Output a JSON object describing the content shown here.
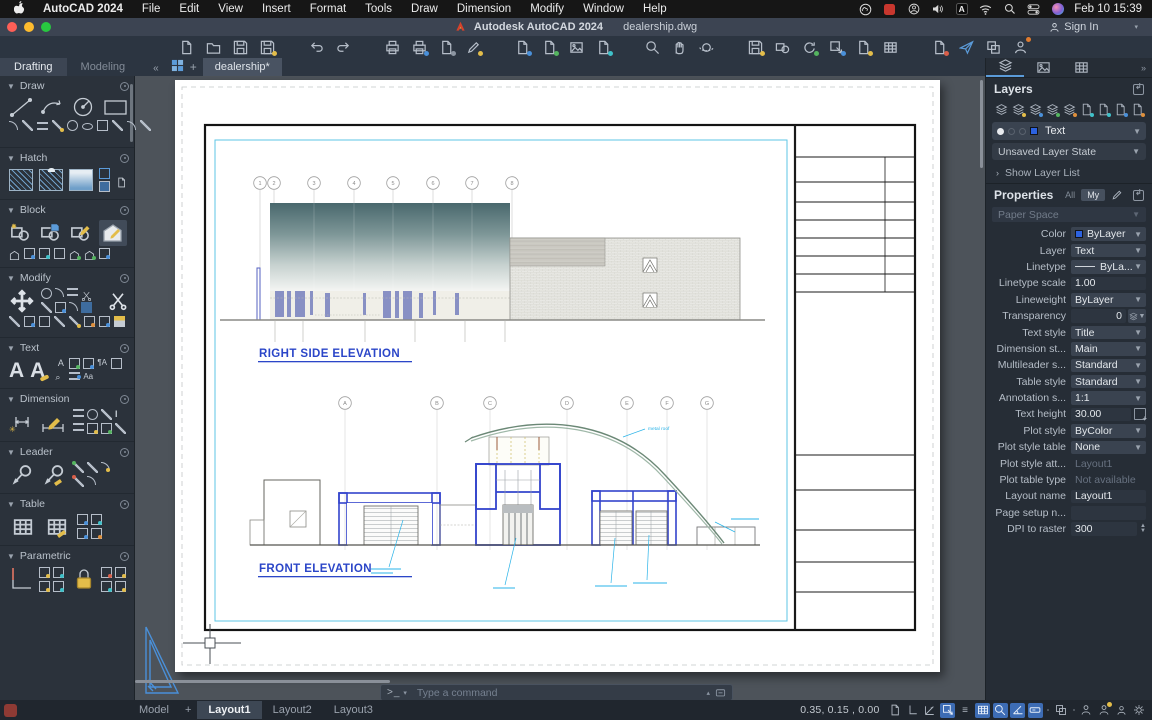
{
  "menubar": {
    "app_name": "AutoCAD 2024",
    "items": [
      "File",
      "Edit",
      "View",
      "Insert",
      "Format",
      "Tools",
      "Draw",
      "Dimension",
      "Modify",
      "Window",
      "Help"
    ],
    "status_icons": [
      "creative-cloud",
      "screen-record",
      "account",
      "volume",
      "input-source",
      "wifi",
      "spotlight",
      "control-center",
      "siri"
    ],
    "clock": "Feb 10 15:39"
  },
  "titlebar": {
    "app_title": "Autodesk AutoCAD 2024",
    "doc_title": "dealership.dwg",
    "sign_in": "Sign In"
  },
  "toolbar_icons": [
    "new",
    "open",
    "save",
    "save-as",
    "undo",
    "redo",
    "plot",
    "plot-preview",
    "publish",
    "edit-drawing",
    "import",
    "attach",
    "image-reference",
    "pdf-import",
    "zoom-window",
    "pan",
    "orbit",
    "annotate",
    "insert-block",
    "update-fields",
    "match-properties",
    "copy-properties",
    "sheet-set",
    "compare",
    "share",
    "app-window",
    "feedback"
  ],
  "palette_tabs": {
    "drafting": "Drafting",
    "modeling": "Modeling",
    "collapse": "«",
    "doc_tab": "dealership*"
  },
  "left_palette": {
    "sections": [
      {
        "name": "Draw"
      },
      {
        "name": "Hatch"
      },
      {
        "name": "Block"
      },
      {
        "name": "Modify"
      },
      {
        "name": "Text"
      },
      {
        "name": "Dimension"
      },
      {
        "name": "Leader"
      },
      {
        "name": "Table"
      },
      {
        "name": "Parametric"
      }
    ]
  },
  "drawing": {
    "right_elevation_title": "RIGHT SIDE ELEVATION",
    "front_elevation_title": "FRONT ELEVATION",
    "top_grid_labels": [
      "1",
      "2",
      "3",
      "4",
      "5",
      "6",
      "7",
      "8"
    ],
    "front_grid_labels": [
      "A",
      "B",
      "C",
      "D",
      "E",
      "F",
      "G"
    ],
    "roof_annotation": "metal roof"
  },
  "command_line": {
    "prompt": ">_",
    "placeholder": "Type a command"
  },
  "layers_panel": {
    "title": "Layers",
    "tool_icons": [
      "new-layer",
      "layer-properties",
      "layer-walk",
      "layer-freeze",
      "layer-off",
      "layer-isolate",
      "layer-unisolate",
      "layer-lock",
      "layer-unlock"
    ],
    "current_layer": "Text",
    "layer_state": "Unsaved Layer State",
    "show_layer_list": "Show Layer List"
  },
  "properties_panel": {
    "title": "Properties",
    "filter_all": "All",
    "filter_my": "My",
    "space": "Paper Space",
    "rows": [
      {
        "label": "Color",
        "value": "ByLayer"
      },
      {
        "label": "Layer",
        "value": "Text"
      },
      {
        "label": "Linetype",
        "value": "ByLa..."
      },
      {
        "label": "Linetype scale",
        "value": "1.00"
      },
      {
        "label": "Lineweight",
        "value": "ByLayer"
      },
      {
        "label": "Transparency",
        "value": "0"
      },
      {
        "label": "Text style",
        "value": "Title"
      },
      {
        "label": "Dimension st...",
        "value": "Main"
      },
      {
        "label": "Multileader s...",
        "value": "Standard"
      },
      {
        "label": "Table style",
        "value": "Standard"
      },
      {
        "label": "Annotation s...",
        "value": "1:1"
      },
      {
        "label": "Text height",
        "value": "30.00"
      },
      {
        "label": "Plot style",
        "value": "ByColor"
      },
      {
        "label": "Plot style table",
        "value": "None"
      },
      {
        "label": "Plot style att...",
        "value": "Layout1"
      },
      {
        "label": "Plot table type",
        "value": "Not available"
      },
      {
        "label": "Layout name",
        "value": "Layout1"
      },
      {
        "label": "Page setup n...",
        "value": ""
      },
      {
        "label": "DPI to raster",
        "value": "300"
      }
    ]
  },
  "status_bar": {
    "model_tab": "Model",
    "layout_tabs": [
      "Layout1",
      "Layout2",
      "Layout3"
    ],
    "active_layout": "Layout1",
    "coordinates": "0.35, 0.15 , 0.00",
    "toggle_icons": [
      "paper-space",
      "ortho",
      "polar-tracking",
      "object-snap",
      "lineweight",
      "grid",
      "snap-cursor",
      "angle-snap",
      "dynamic-input",
      "selection-cycling",
      "annotation-monitor",
      "annotation-star",
      "annotation-scale",
      "settings"
    ]
  },
  "colors": {
    "accent_blue": "#3d6cb4",
    "drawing_blue": "#2b46c8",
    "annotation_cyan": "#2ab3e8",
    "roof_green": "#7fA08b",
    "layer_swatch": "#2c62e0"
  }
}
